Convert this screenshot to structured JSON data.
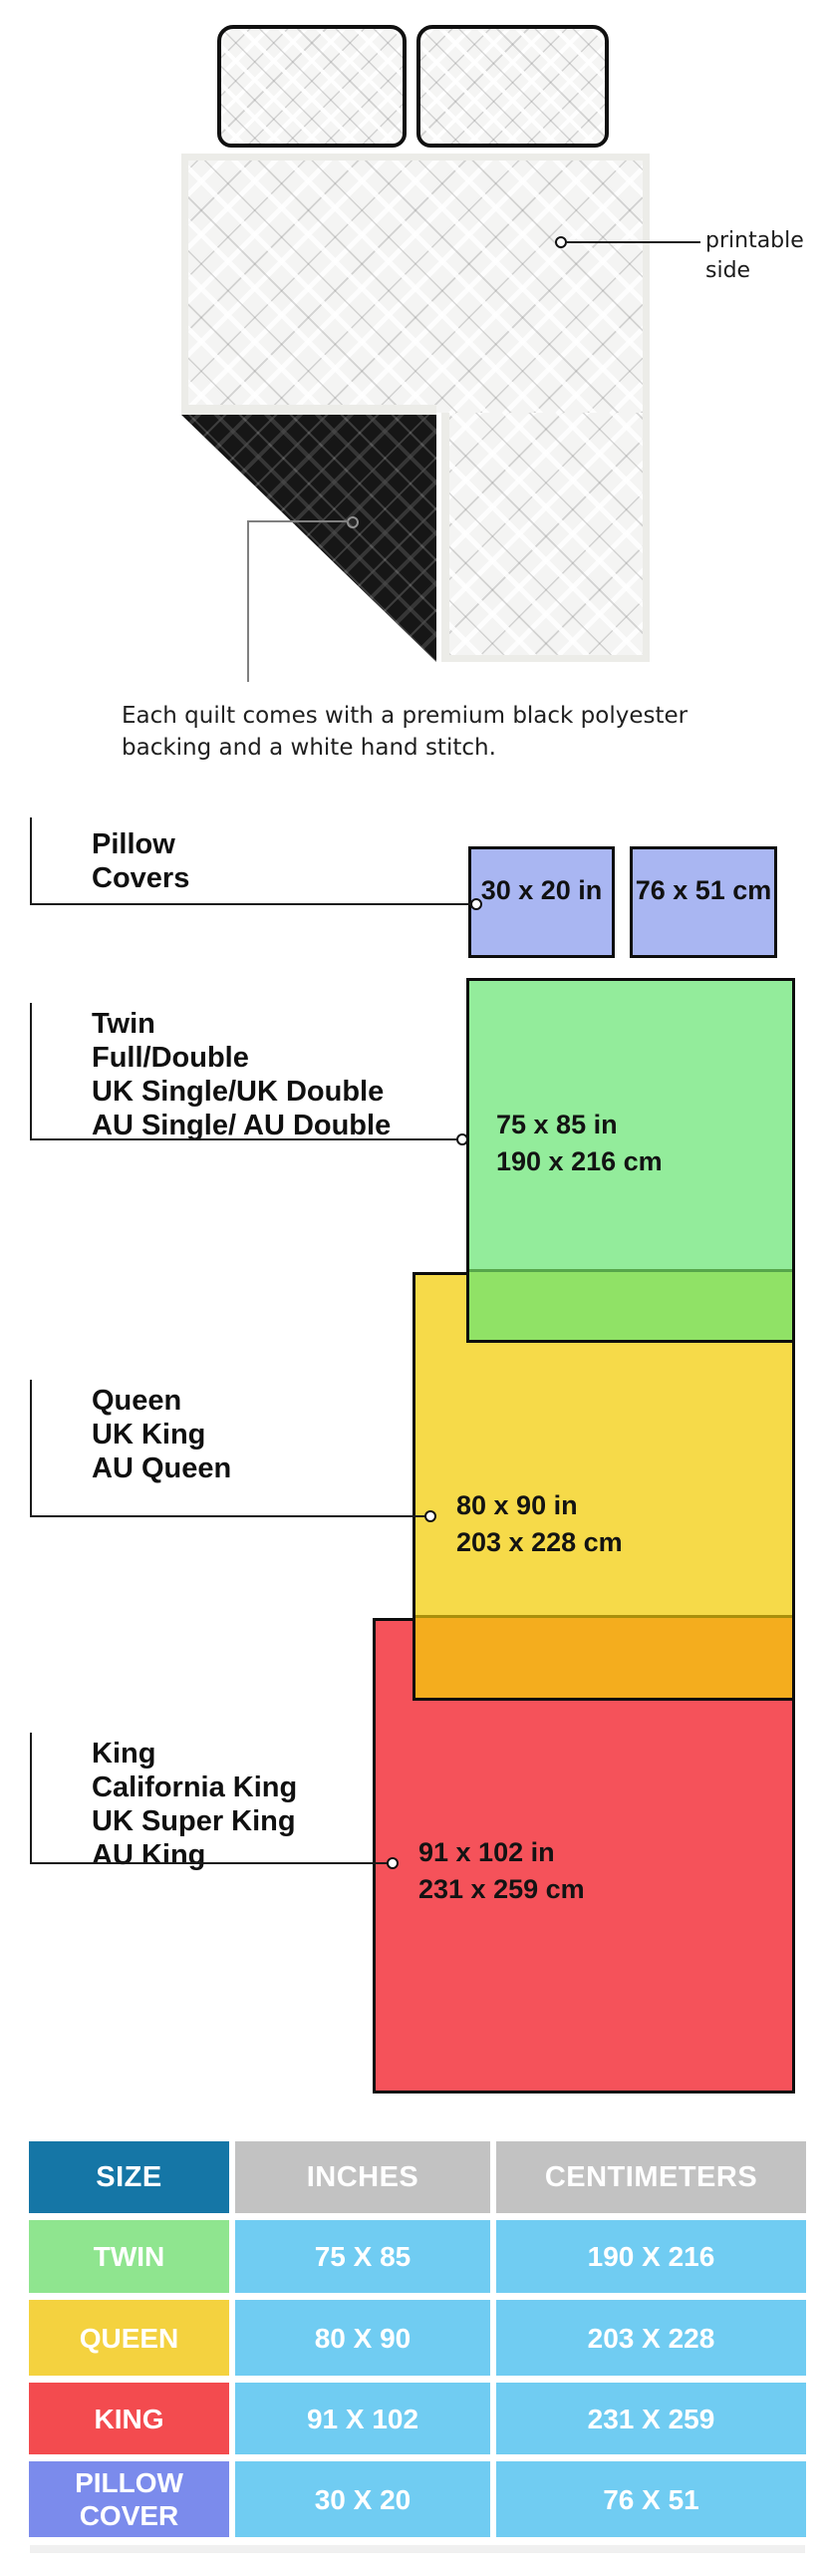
{
  "illustration": {
    "printable_label_line1": "printable",
    "printable_label_line2": "side",
    "caption_line1": "Each quilt comes with a premium black polyester",
    "caption_line2": "backing and a white hand stitch."
  },
  "diagram": {
    "pillow_covers": {
      "labels": [
        "Pillow",
        "Covers"
      ],
      "size_in": "30 x 20 in",
      "size_cm": "76 x 51 cm",
      "fill_color": "#A9B6F2"
    },
    "twin": {
      "labels": [
        "Twin",
        "Full/Double",
        "UK Single/UK Double",
        "AU Single/ AU Double"
      ],
      "size_in": "75 x 85 in",
      "size_cm": "190 x 216 cm",
      "fill_color": "#93EC9B",
      "overlap_color": "#90E266"
    },
    "queen": {
      "labels": [
        "Queen",
        "UK King",
        "AU Queen"
      ],
      "size_in": "80 x 90 in",
      "size_cm": "203 x 228 cm",
      "fill_color": "#F6DA49",
      "overlap_color": "#F4AD1E"
    },
    "king": {
      "labels": [
        "King",
        "California King",
        "UK Super King",
        "AU King"
      ],
      "size_in": "91 x 102 in",
      "size_cm": "231 x 259 cm",
      "fill_color": "#F5525A"
    },
    "border_color": "#0d0d0d"
  },
  "table": {
    "headers": [
      "SIZE",
      "INCHES",
      "CENTIMETERS"
    ],
    "rows": [
      {
        "name": "TWIN",
        "inches": "75 X 85",
        "cm": "190 X 216",
        "color": "#8FE58F"
      },
      {
        "name": "QUEEN",
        "inches": "80 X 90",
        "cm": "203 X 228",
        "color": "#F4D23F"
      },
      {
        "name": "KING",
        "inches": "91 X 102",
        "cm": "231 X 259",
        "color": "#F34B4F"
      },
      {
        "name": "PILLOW COVER",
        "inches": "30 X 20",
        "cm": "76 X 51",
        "color": "#7B8BEC"
      }
    ],
    "header_size_color": "#1576A6",
    "header_gray_color": "#C2C2C2",
    "value_cell_color": "#70CCF2",
    "text_color": "#FFFFFF"
  }
}
